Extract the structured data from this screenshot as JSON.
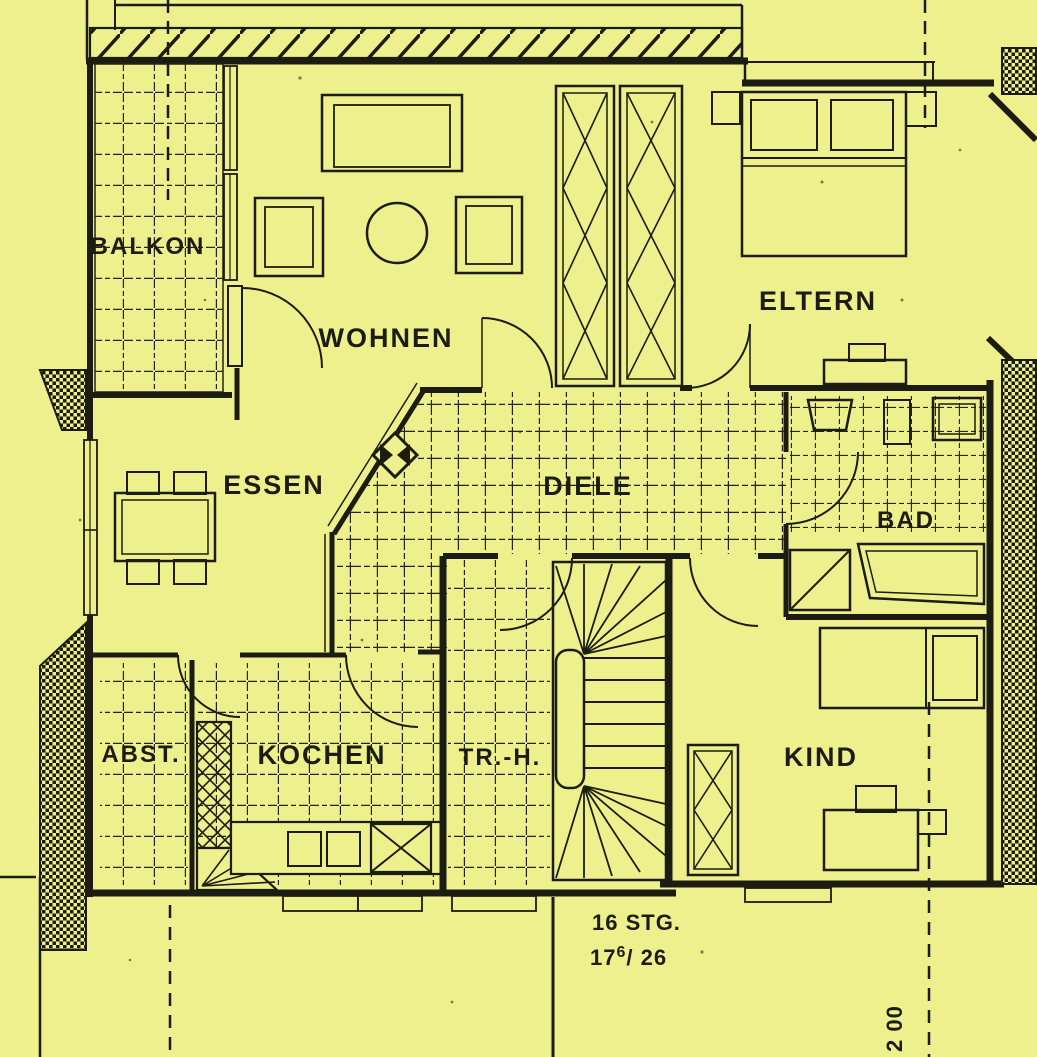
{
  "colors": {
    "paper": "#edf08c",
    "ink": "#1d1c12"
  },
  "rooms": [
    {
      "id": "balkon",
      "label": "BALKON"
    },
    {
      "id": "wohnen",
      "label": "WOHNEN"
    },
    {
      "id": "essen",
      "label": "ESSEN"
    },
    {
      "id": "eltern",
      "label": "ELTERN"
    },
    {
      "id": "diele",
      "label": "DIELE"
    },
    {
      "id": "bad",
      "label": "BAD"
    },
    {
      "id": "abstellraum",
      "label": "ABST."
    },
    {
      "id": "kochen",
      "label": "KOCHEN"
    },
    {
      "id": "treppenhaus",
      "label": "TR.-H."
    },
    {
      "id": "kind",
      "label": "KIND"
    }
  ],
  "annotations": {
    "stair_count": "16 STG.",
    "stair_ratio_base": "17",
    "stair_ratio_sup": "6",
    "stair_ratio_rest": "/ 26",
    "dimension": "2 00"
  }
}
